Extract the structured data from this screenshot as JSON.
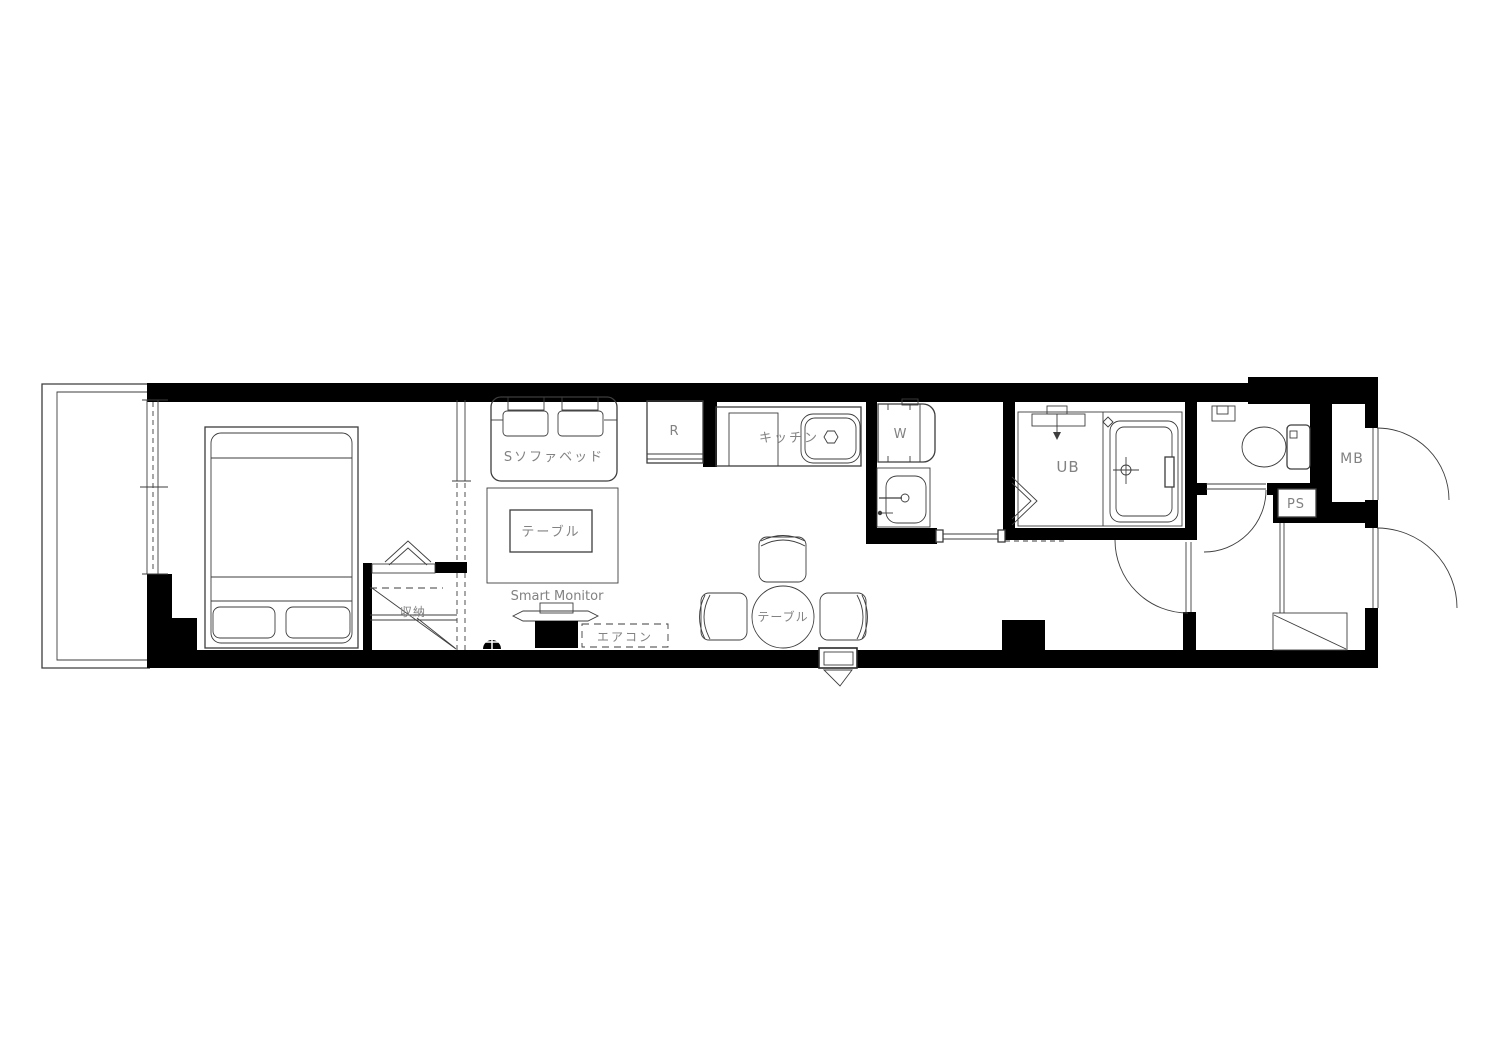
{
  "floorplan": {
    "labels": {
      "sofa_bed": "Sソファベッド",
      "living_table": "テーブル",
      "smart_monitor": "Smart Monitor",
      "air_conditioner": "エアコン",
      "refrigerator": "R",
      "kitchen": "キッチン",
      "dining_table": "テーブル",
      "washer": "W",
      "unit_bath": "UB",
      "storage": "収納",
      "meter_box": "MB",
      "pipe_space": "PS"
    },
    "colors": {
      "wall": "#000000",
      "furniture_line": "#3d3d3d",
      "label_text": "#828282",
      "background": "#ffffff"
    }
  }
}
